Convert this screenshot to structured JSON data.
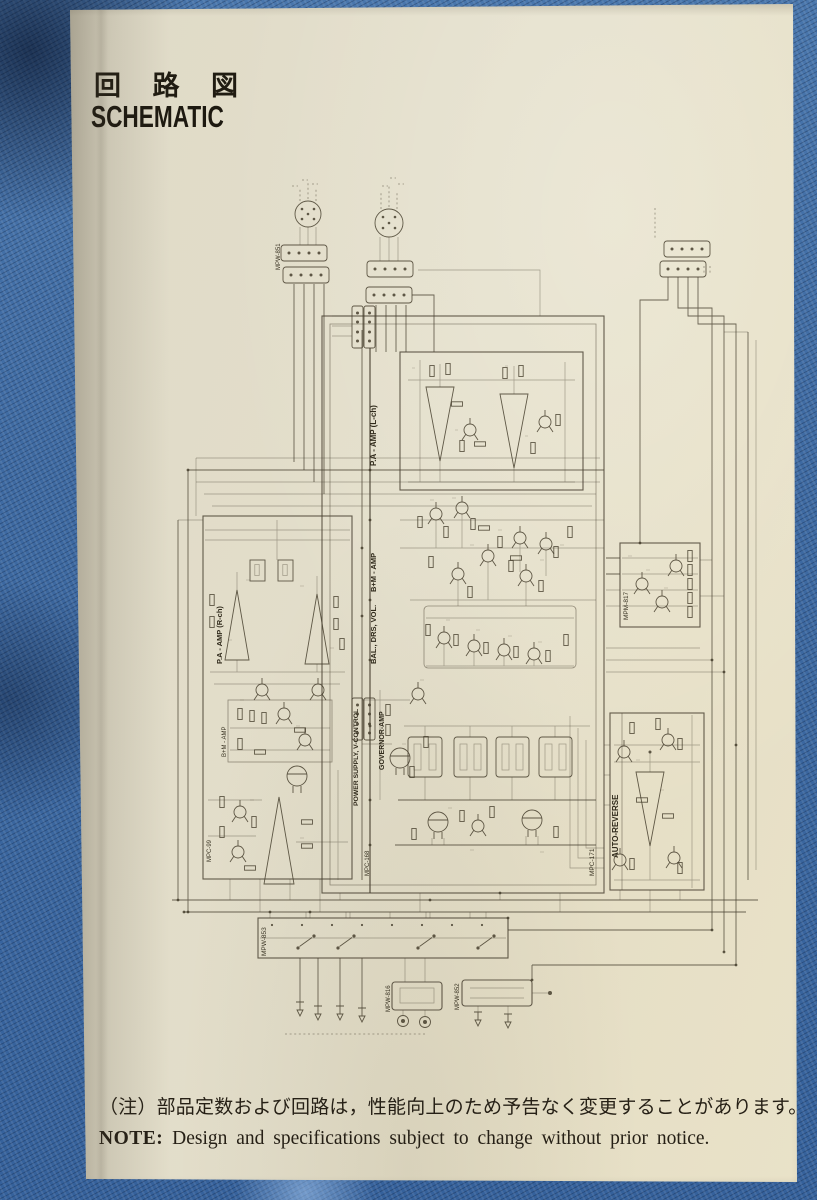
{
  "header": {
    "title_jp": "回 路 図",
    "title_en": "SCHEMATIC"
  },
  "footer": {
    "note_jp": "（注）部品定数および回路は，性能向上のため予告なく変更することがあります。",
    "note_en_label": "NOTE:",
    "note_en": "Design and specifications subject to change without prior notice."
  },
  "schematic": {
    "block_labels": {
      "pa_amp_l": "P.A - AMP (L-ch)",
      "b_m_amp": "B+M - AMP",
      "bal_drs_vol": "BAL., DRS, VOL.",
      "power_supply": "POWER SUPPLY, V-CONTROL",
      "governor_amp": "GOVERNOR-AMP",
      "pa_amp_r": "P.A - AMP (R-ch)",
      "b_m_amp_r": "B+M - AMP",
      "auto_reverse": "AUTO-REVERSE"
    },
    "board_labels": {
      "mpw_851": "MPW-851",
      "mpm_817": "MPM-817",
      "mpc_171": "MPC-171",
      "mpc_99": "MPC-99",
      "mpc_168": "MPC-168",
      "mpw_853": "MPW-853",
      "mpw_816": "MPW-816",
      "mpw_852": "MPW-852"
    }
  },
  "colors": {
    "paper": "#e3deca",
    "fabric_blue": "#3e6aa2",
    "ink": "#4a4232",
    "text": "#262016"
  }
}
